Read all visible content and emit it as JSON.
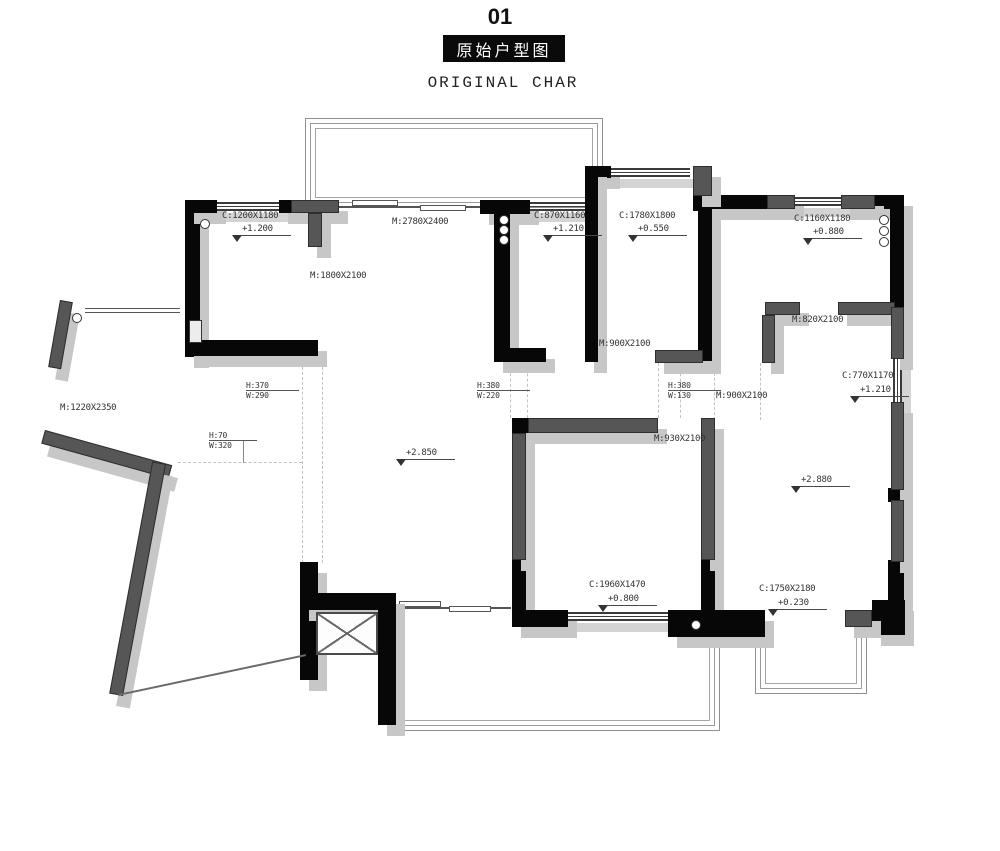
{
  "title": {
    "number": "01",
    "cn": "原始户型图",
    "en": "ORIGINAL CHAR"
  },
  "annotations": {
    "c1200": {
      "label": "C:1200X1180",
      "level": "+1.200"
    },
    "m1800": {
      "label": "M:1800X2100"
    },
    "m2780": {
      "label": "M:2780X2400"
    },
    "c870": {
      "label": "C:870X1160",
      "level": "+1.210"
    },
    "c1780": {
      "label": "C:1780X1800",
      "level": "+0.550"
    },
    "c1160": {
      "label": "C:1160X1180",
      "level": "+0.880"
    },
    "m820": {
      "label": "M:820X2100"
    },
    "m900_hall": {
      "label": "M:900X2100"
    },
    "m900_right": {
      "label": "M:900X2100"
    },
    "m930": {
      "label": "M:930X2100"
    },
    "m1220": {
      "label": "M:1220X2350"
    },
    "hw_370": {
      "h": "H:370",
      "w": "W:290"
    },
    "hw_380a": {
      "h": "H:380",
      "w": "W:220"
    },
    "hw_380b": {
      "h": "H:380",
      "w": "W:130"
    },
    "hw_70": {
      "h": "H:70",
      "w": "W:320"
    },
    "lvl_2850": {
      "level": "+2.850"
    },
    "lvl_2880": {
      "level": "+2.880"
    },
    "c770": {
      "label": "C:770X1170",
      "level": "+1.210"
    },
    "c1960": {
      "label": "C:1960X1470",
      "level": "+0.800"
    },
    "c1750": {
      "label": "C:1750X2180",
      "level": "+0.230"
    }
  },
  "colors": {
    "wall_black": "#070707",
    "wall_gray": "#565656",
    "shadow": "#c7c7c7",
    "railing_line": "#8f8f8f",
    "text": "#333333",
    "title_box_bg": "#0a0a0a",
    "title_box_text": "#ffffff"
  }
}
